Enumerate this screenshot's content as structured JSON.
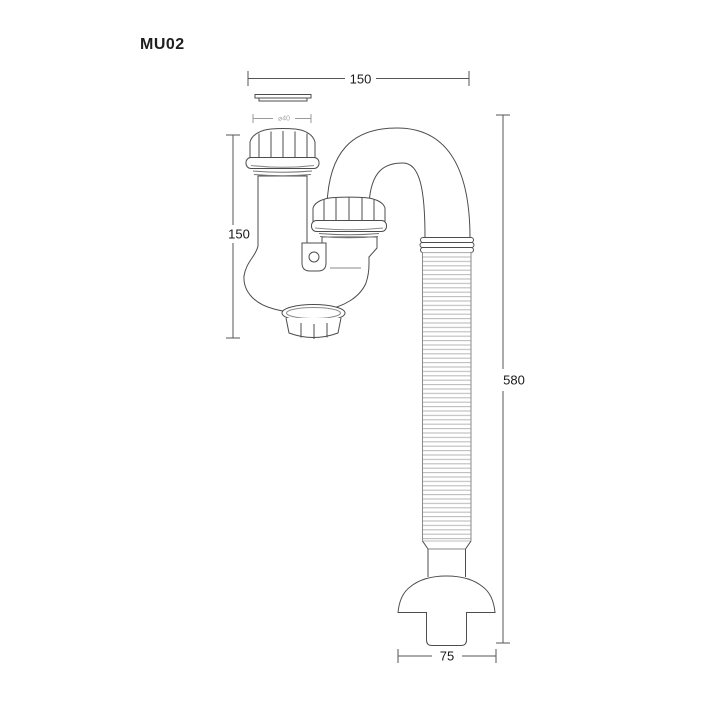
{
  "title": "MU02",
  "drawing": {
    "dimensions": {
      "top_width": "150",
      "inlet_height": "150",
      "overall_height": "580",
      "outlet_width": "75",
      "inlet_diameter": "⌀40"
    },
    "colors": {
      "line": "#4d4d4d",
      "light_line": "#8a8a8a",
      "corrugation": "#bcbcbc",
      "dimension_text": "#1a1a1a",
      "faint_text": "#a6a6a6",
      "background": "#ffffff"
    }
  }
}
